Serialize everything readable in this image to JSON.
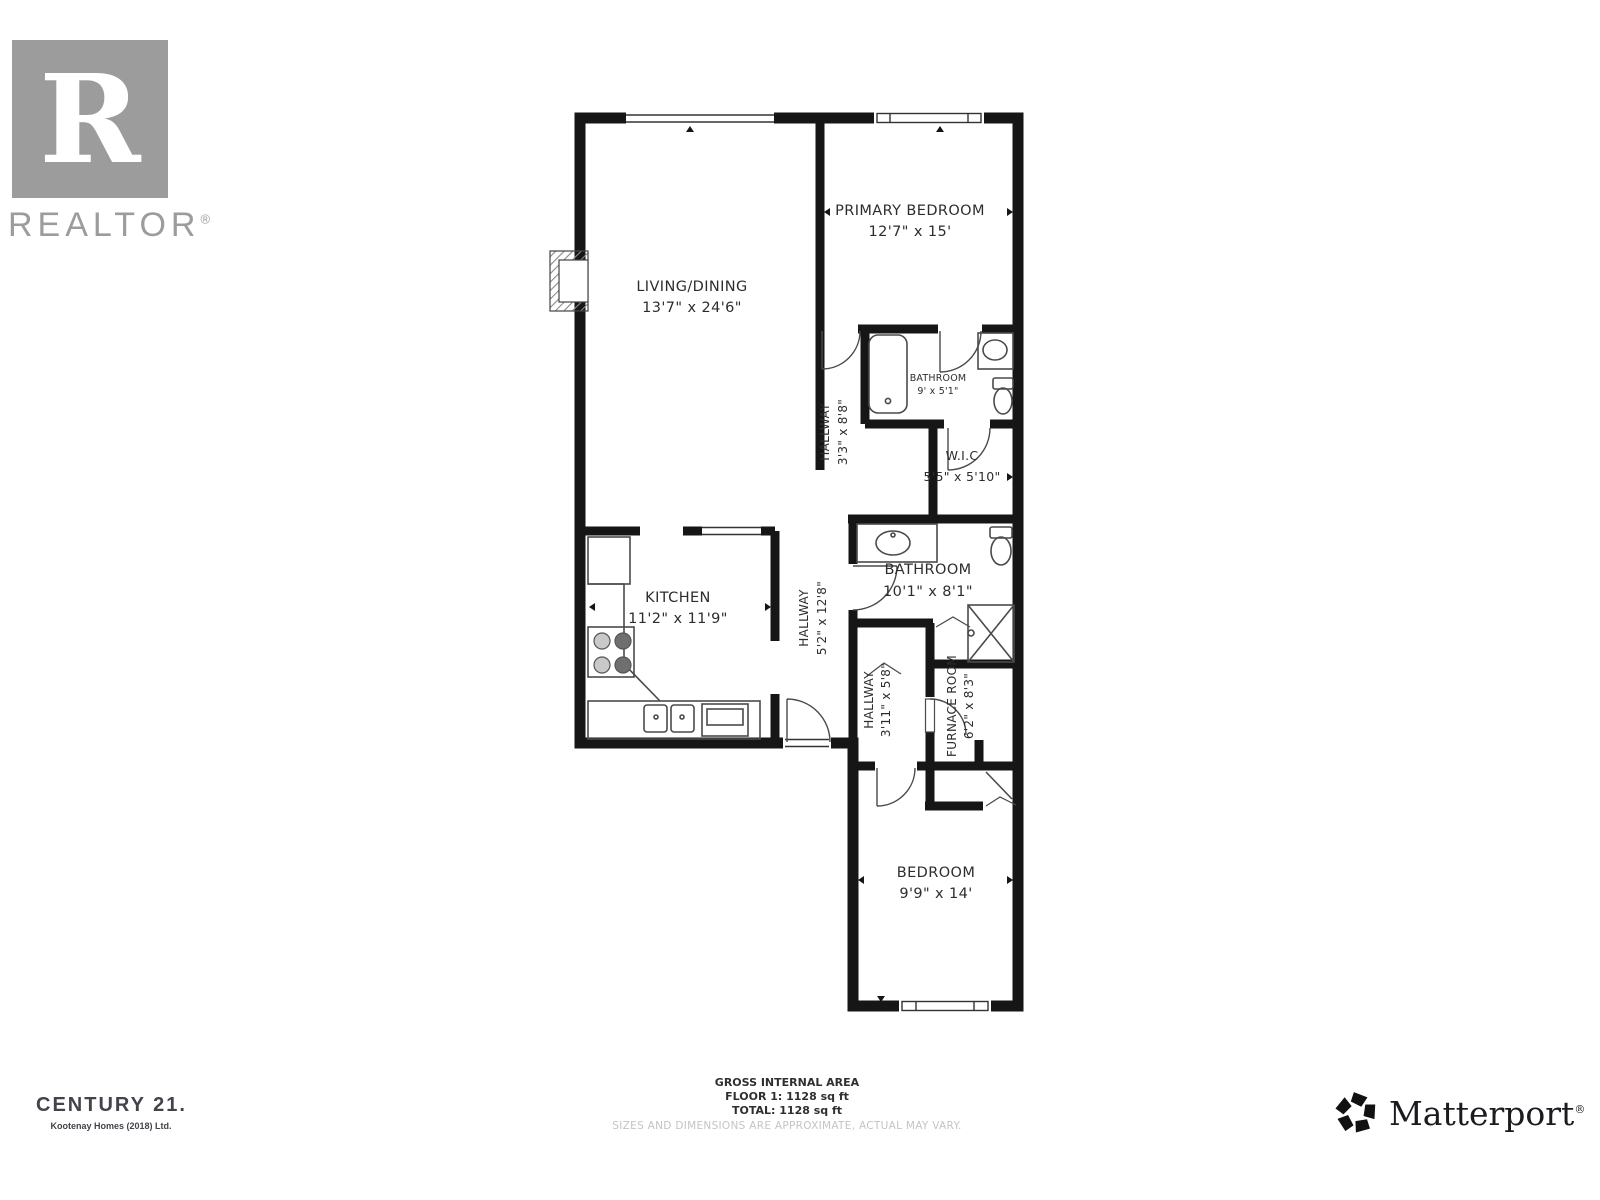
{
  "floor_plan": {
    "rooms": [
      {
        "id": "living-dining",
        "name": "LIVING/DINING",
        "dims": "13'7\" x 24'6\""
      },
      {
        "id": "primary-bedroom",
        "name": "PRIMARY BEDROOM",
        "dims": "12'7\" x 15'"
      },
      {
        "id": "ensuite-bathroom",
        "name": "BATHROOM",
        "dims": "9' x 5'1\""
      },
      {
        "id": "hallway-upper",
        "name": "HALLWAY",
        "dims": "3'3\" x 8'8\""
      },
      {
        "id": "walk-in-closet",
        "name": "W.I.C",
        "dims": "5'5\" x 5'10\""
      },
      {
        "id": "main-bathroom",
        "name": "BATHROOM",
        "dims": "10'1\" x 8'1\""
      },
      {
        "id": "kitchen",
        "name": "KITCHEN",
        "dims": "11'2\" x 11'9\""
      },
      {
        "id": "hallway-main",
        "name": "HALLWAY",
        "dims": "5'2\" x 12'8\""
      },
      {
        "id": "hallway-lower",
        "name": "HALLWAY",
        "dims": "3'11\" x 5'8\""
      },
      {
        "id": "furnace-room",
        "name": "FURNACE ROOM",
        "dims": "6'2\" x 8'3\""
      },
      {
        "id": "bedroom",
        "name": "BEDROOM",
        "dims": "9'9\" x 14'"
      }
    ]
  },
  "footer": {
    "area_title": "GROSS INTERNAL AREA",
    "floor_line": "FLOOR 1: 1128 sq ft",
    "total_line": "TOTAL: 1128 sq ft",
    "disclaimer": "SIZES AND DIMENSIONS ARE APPROXIMATE, ACTUAL MAY VARY."
  },
  "branding": {
    "realtor": {
      "letter": "R",
      "word": "REALTOR",
      "reg": "®"
    },
    "century21": {
      "name": "CENTURY 21.",
      "sub": "Kootenay Homes (2018) Ltd."
    },
    "matterport": {
      "word": "Matterport",
      "reg": "®"
    }
  },
  "colors": {
    "wall": "#161616",
    "realtor_gray": "#9c9c9c",
    "century_charcoal": "#43434b",
    "disclaimer_gray": "#c4c4c4"
  }
}
